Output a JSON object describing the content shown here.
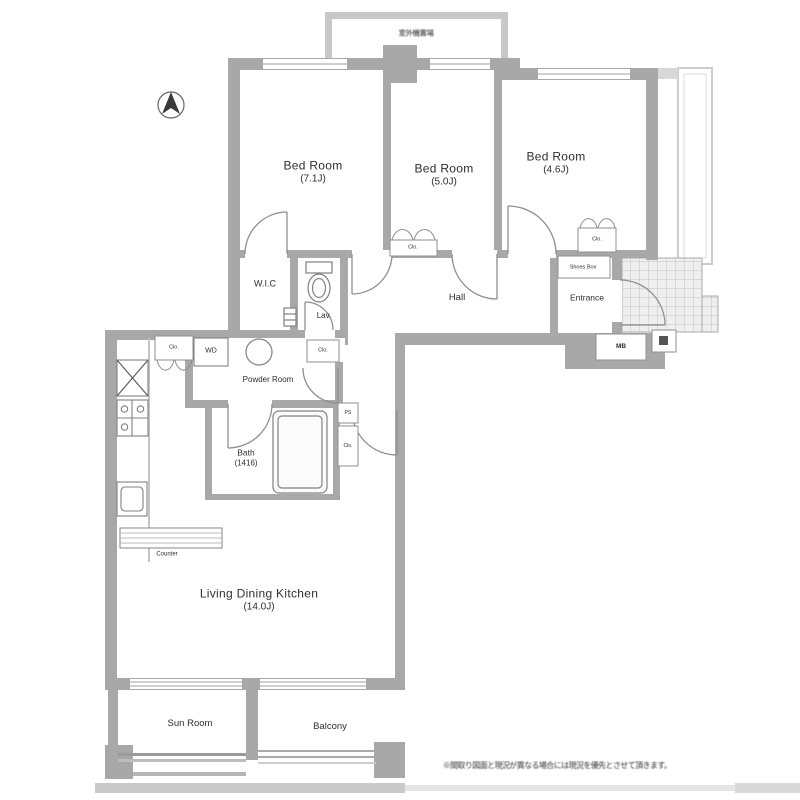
{
  "meta": {
    "background": "#ffffff",
    "wall_color": "#a8a8a8",
    "light_wall_color": "#c8c8c8",
    "line_color": "#8a8a8a",
    "text_color": "#2e2e2e"
  },
  "outdoor_unit": {
    "label": "室外機置場"
  },
  "rooms": {
    "bedroom1": {
      "name": "Bed Room",
      "size": "(7.1J)"
    },
    "bedroom2": {
      "name": "Bed Room",
      "size": "(5.0J)"
    },
    "bedroom3": {
      "name": "Bed Room",
      "size": "(4.6J)"
    },
    "wic": {
      "name": "W.I.C"
    },
    "lavatory": {
      "name": "Lav."
    },
    "hall": {
      "name": "Hall"
    },
    "entrance": {
      "name": "Entrance"
    },
    "shoes_box": {
      "name": "Shoes Box"
    },
    "meter_box": {
      "name": "MB"
    },
    "powder_room": {
      "name": "Powder Room"
    },
    "washer_dryer": {
      "name": "WD"
    },
    "bath": {
      "name": "Bath",
      "size": "(1416)"
    },
    "ldk": {
      "name": "Living Dining Kitchen",
      "size": "(14.0J)"
    },
    "counter": {
      "name": "Counter"
    },
    "sun_room": {
      "name": "Sun Room"
    },
    "balcony": {
      "name": "Balcony"
    }
  },
  "closets": {
    "kitchen_closet": "Clo.",
    "bedroom2_closet": "Clo.",
    "bedroom3_closet": "Clo.",
    "corridor_closet": "Clo.",
    "bathside_closet": "Clo.",
    "pipe_space": "PS"
  },
  "disclaimer": "※間取り図面と現況が異なる場合には現況を優先とさせて頂きます。"
}
